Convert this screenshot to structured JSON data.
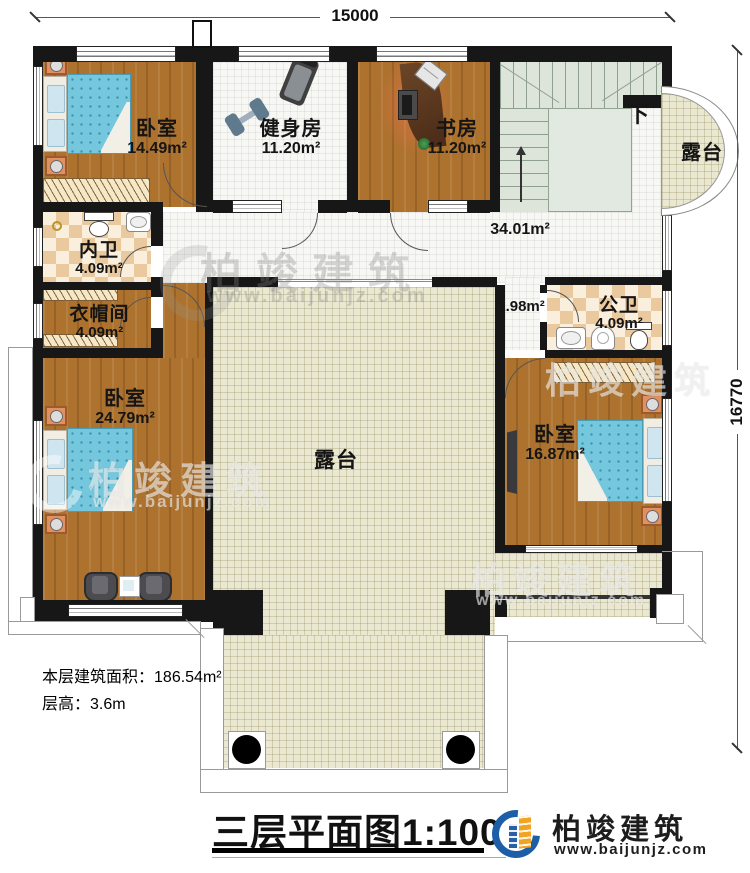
{
  "dimensions": {
    "width": "15000",
    "height": "16770"
  },
  "rooms": {
    "bedroom_tl": {
      "name": "卧室",
      "area": "14.49m²"
    },
    "gym": {
      "name": "健身房",
      "area": "11.20m²"
    },
    "study": {
      "name": "书房",
      "area": "11.20m²"
    },
    "terrace_right": {
      "name": "露台"
    },
    "hallway": {
      "area": "34.01m²"
    },
    "inner_bath": {
      "name": "内卫",
      "area": "4.09m²"
    },
    "cloakroom": {
      "name": "衣帽间",
      "area": "4.09m²"
    },
    "bedroom_left": {
      "name": "卧室",
      "area": "24.79m²"
    },
    "terrace_center": {
      "name": "露台"
    },
    "nook": {
      "area": "1.98m²"
    },
    "public_bath": {
      "name": "公卫",
      "area": "4.09m²"
    },
    "bedroom_right": {
      "name": "卧室",
      "area": "16.87m²"
    }
  },
  "stairs": {
    "down_label": "下"
  },
  "info": {
    "area_label": "本层建筑面积：",
    "area_value": "186.54m²",
    "height_label": "层高：",
    "height_value": "3.6m"
  },
  "title": {
    "main": "三层平面图",
    "scale": "1:100"
  },
  "brand": {
    "name": "柏竣建筑",
    "website": "www.baijunjz.com"
  },
  "watermark": {
    "name": "柏竣建筑",
    "website": "www.baijunjz.com"
  },
  "colors": {
    "wall": "#171717",
    "wood": "#ad722e",
    "tile": "#f7f7f4",
    "terrace": "#ebe8d1",
    "stair": "#dde4da",
    "bed": "#74c7dd",
    "brand_blue": "#1d5fa7",
    "brand_orange": "#f2a31f"
  }
}
